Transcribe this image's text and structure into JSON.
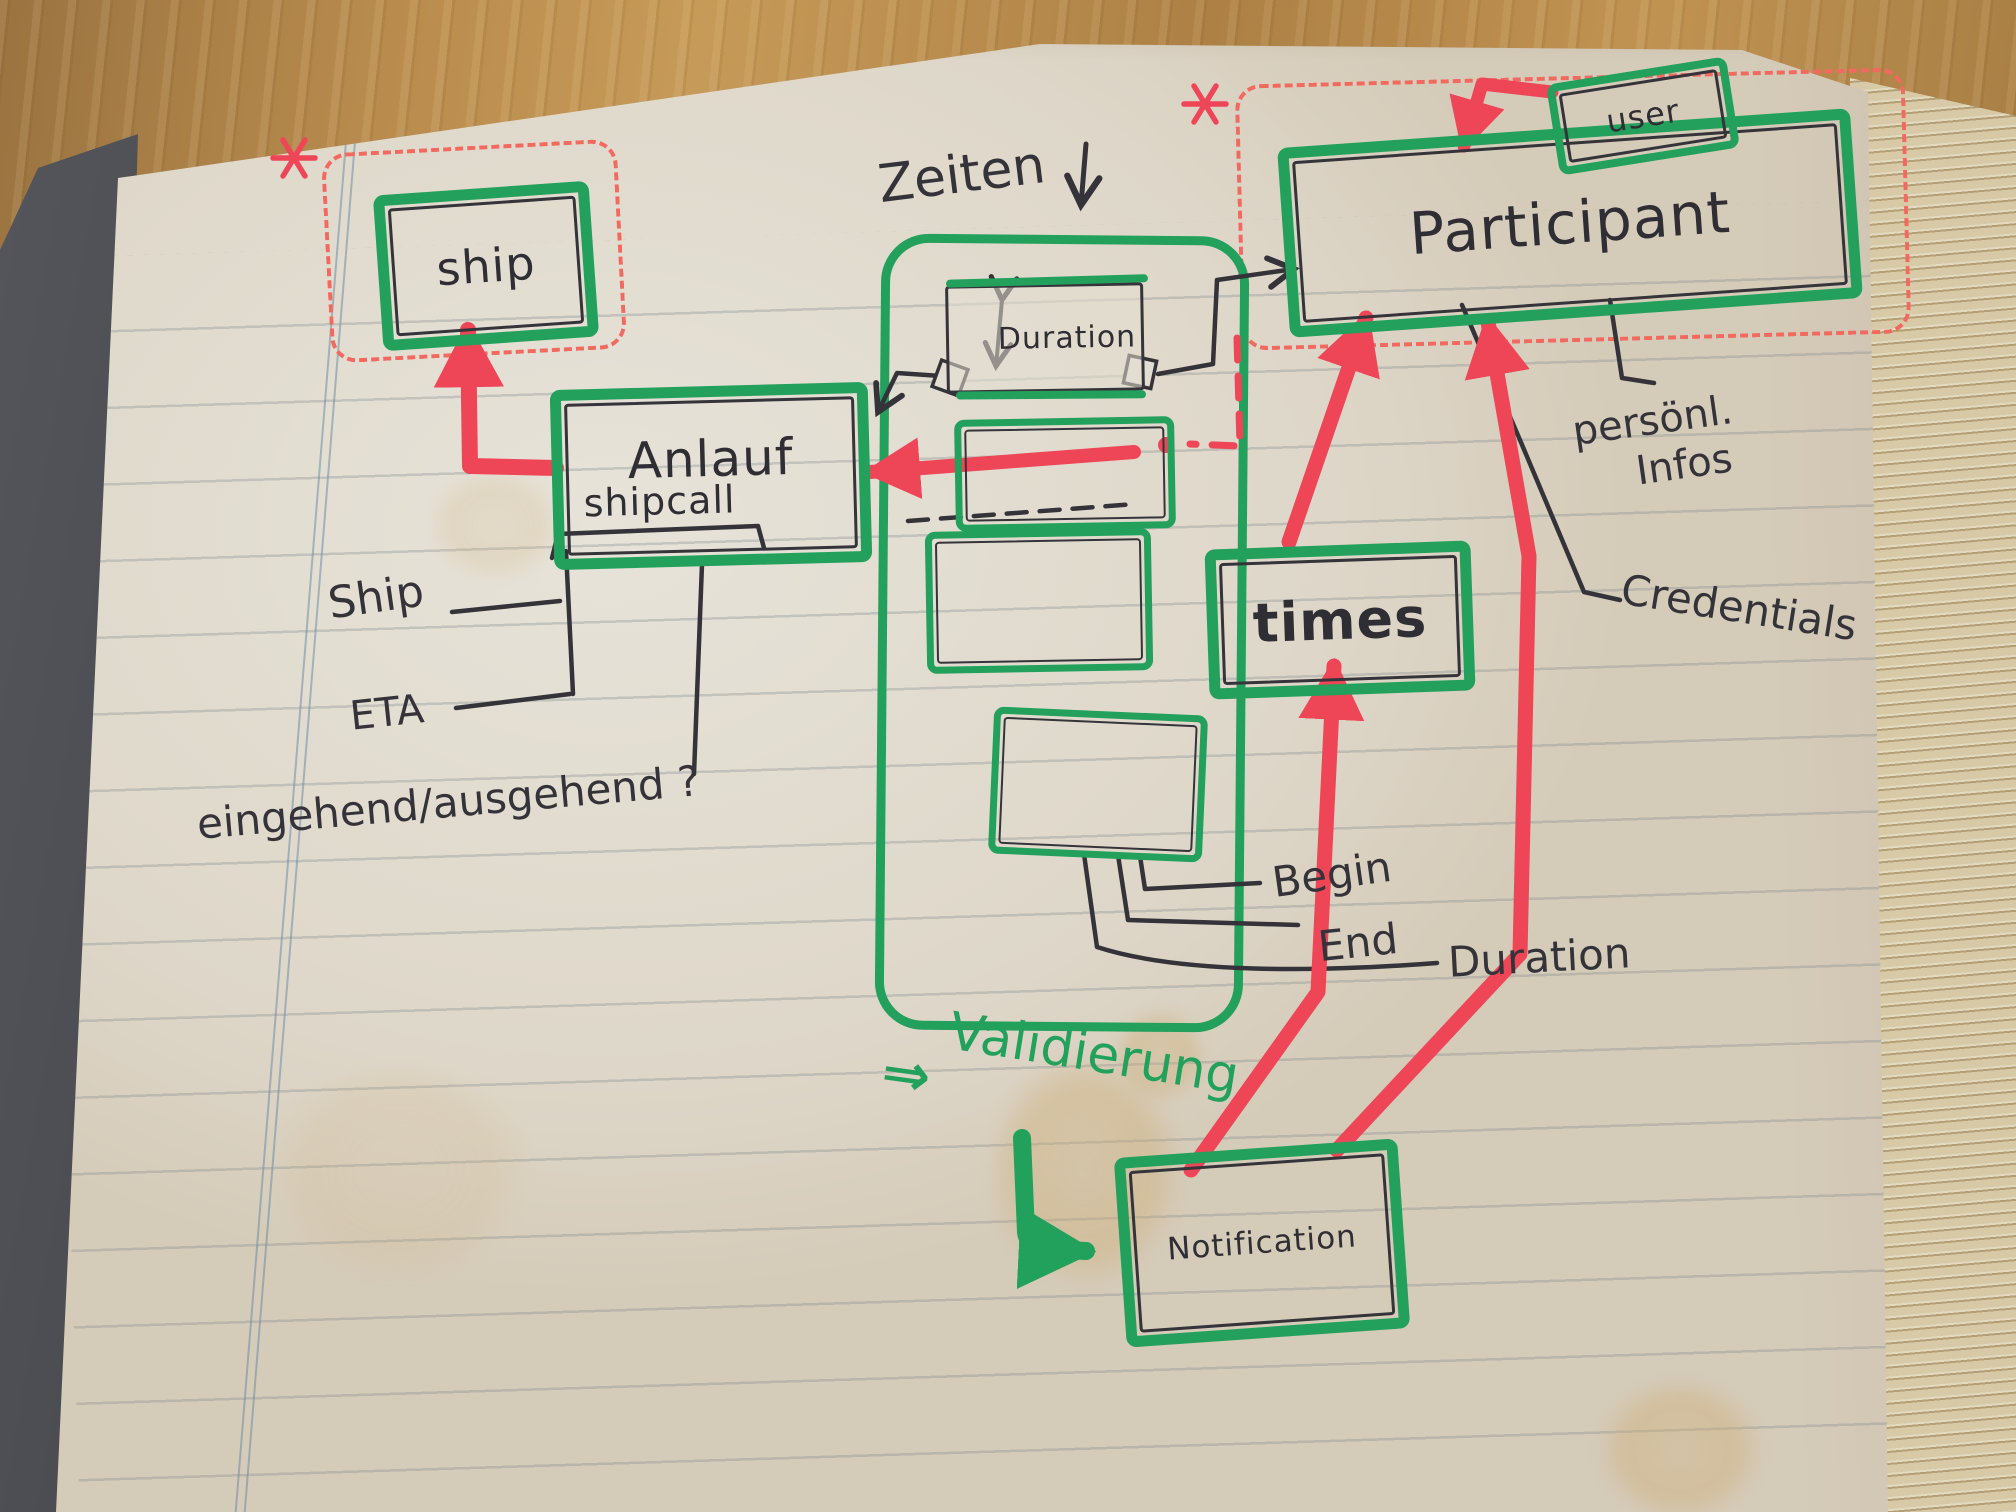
{
  "colors": {
    "marker_green": "#23a05c",
    "marker_red": "#ee4557",
    "ink": "#35343a",
    "paper": "#e0dad0"
  },
  "entities": {
    "ship": {
      "label": "ship"
    },
    "shipcall": {
      "label": "Anlauf",
      "sublabel": "shipcall"
    },
    "participant": {
      "label": "Participant"
    },
    "user": {
      "label": "user"
    },
    "duration": {
      "label": "Duration"
    },
    "times": {
      "label": "times"
    },
    "notification": {
      "label": "Notification"
    }
  },
  "groups": {
    "zeiten": {
      "label": "Zeiten"
    },
    "validierung": {
      "label": "Validierung",
      "arrow": "⇒"
    }
  },
  "attributes": {
    "ship_attr": "Ship",
    "eta": "ETA",
    "in_out": "eingehend/ausgehend ?",
    "personal_line1": "persönl.",
    "personal_line2": "Infos",
    "credentials": "Credentials",
    "begin": "Begin",
    "end": "End",
    "duration": "Duration"
  }
}
